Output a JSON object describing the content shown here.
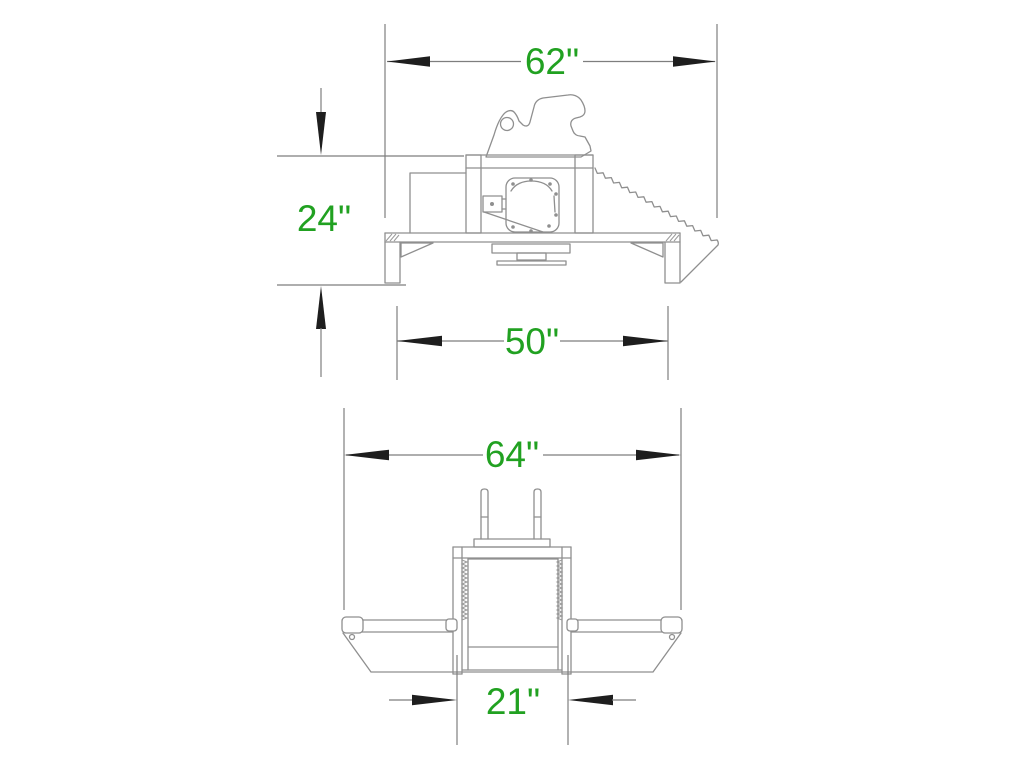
{
  "document": {
    "kind": "technical-dimension-drawing",
    "background_color": "#ffffff",
    "units": "in"
  },
  "colors": {
    "drawing_line": "#8f8f8f",
    "dimension_line": "#7e7e7e",
    "arrowhead": "#1e1e1e",
    "dimension_text": "#21a121"
  },
  "views": {
    "side": {
      "dimensions": {
        "overall_length": {
          "value": 62,
          "unit": "in",
          "label": "62\""
        },
        "height": {
          "value": 24,
          "unit": "in",
          "label": "24\""
        },
        "base_length": {
          "value": 50,
          "unit": "in",
          "label": "50\""
        }
      }
    },
    "front": {
      "dimensions": {
        "overall_width": {
          "value": 64,
          "unit": "in",
          "label": "64\""
        },
        "jaw_opening": {
          "value": 21,
          "unit": "in",
          "label": "21\""
        }
      }
    }
  }
}
